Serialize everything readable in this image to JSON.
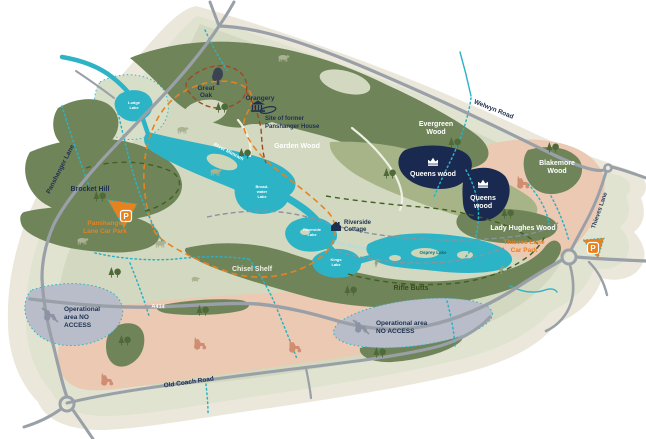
{
  "map": {
    "roads": {
      "panshanger_lane": "Panshanger Lane",
      "welwyn_road": "Welwyn Road",
      "thieves_lane": "Thieves Lane",
      "old_coach_road": "Old Coach Road",
      "a414": "A414"
    },
    "woods": {
      "brocket_hill": "Brocket Hill",
      "garden_wood": "Garden Wood",
      "evergreen_1": "Evergreen",
      "evergreen_2": "Wood",
      "queens_a": "Queens wood",
      "queens_b1": "Queens",
      "queens_b2": "wood",
      "blakemore_1": "Blakemore",
      "blakemore_2": "Wood",
      "lady_hughes": "Lady Hughes Wood",
      "chisel_shelf": "Chisel Shelf",
      "rifle_butts": "Rifle Butts"
    },
    "water": {
      "lodge_1": "Lodge",
      "lodge_2": "Lake",
      "broadwater_1": "Broad-",
      "broadwater_2": "water",
      "broadwater_3": "Lake",
      "riverside_1": "Riverside",
      "riverside_2": "Lake",
      "kings_1": "Kings",
      "kings_2": "Lake",
      "osprey": "Osprey Lake",
      "river_upper": "River Mimram",
      "river_lower": "River Mimram"
    },
    "poi": {
      "great_oak_1": "Great",
      "great_oak_2": "Oak",
      "orangery": "Orangery",
      "former_house_1": "Site of former",
      "former_house_2": "Panshanger House",
      "cottage_1": "Riverside",
      "cottage_2": "Cottage"
    },
    "car_parks": {
      "symbol": "P",
      "panshanger_1": "Panshanger",
      "panshanger_2": "Lane Car Park",
      "thieves_1": "Thieves Lane",
      "thieves_2": "Car Park"
    },
    "operational": {
      "left_1": "Operational",
      "left_2": "area NO",
      "left_3": "ACCESS",
      "bottom_1": "Operational area",
      "bottom_2": "NO ACCESS"
    },
    "colors": {
      "water": "#2db3c6",
      "wood_dark": "#70845a",
      "queens_navy": "#1a2950",
      "salmon": "#ecc9b2",
      "operational_gray": "#b8bdc9",
      "car_park_orange": "#e8821e",
      "label_navy": "#1d3050",
      "road_gray": "#9aa0a8"
    }
  }
}
